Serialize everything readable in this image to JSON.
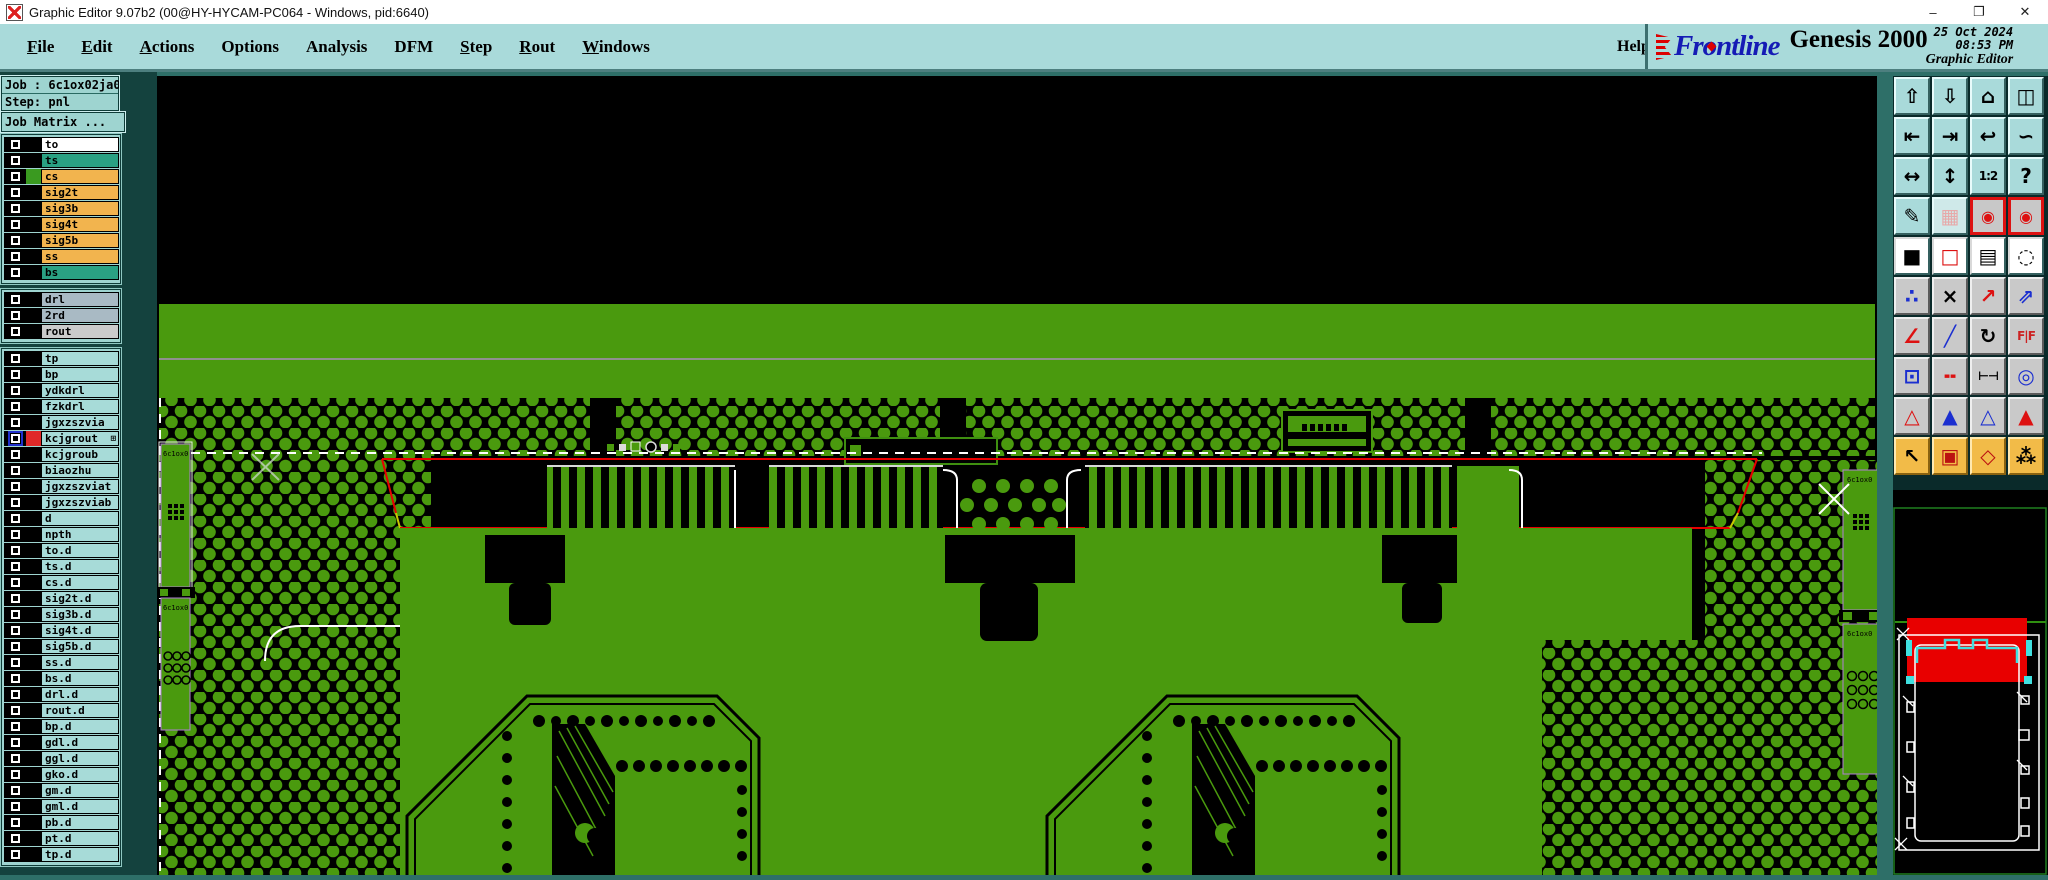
{
  "window": {
    "title": "Graphic Editor 9.07b2 (00@HY-HYCAM-PC064 - Windows, pid:6640)",
    "minimize": "–",
    "maximize": "❐",
    "close": "✕"
  },
  "menu": {
    "items": [
      {
        "label": "File",
        "underline": 0
      },
      {
        "label": "Edit",
        "underline": 0
      },
      {
        "label": "Actions",
        "underline": 0
      },
      {
        "label": "Options",
        "underline": -1
      },
      {
        "label": "Analysis",
        "underline": -1
      },
      {
        "label": "DFM",
        "underline": -1
      },
      {
        "label": "Step",
        "underline": 0
      },
      {
        "label": "Rout",
        "underline": 0
      },
      {
        "label": "Windows",
        "underline": 0
      }
    ],
    "help": "Help"
  },
  "branding": {
    "logo_pre": "Fr",
    "logo_o": "o",
    "logo_post": "ntline",
    "product": "Genesis 2000",
    "date": "25 Oct 2024",
    "time": "08:53 PM",
    "subtitle": "Graphic Editor"
  },
  "sidebar": {
    "job_line": "Job : 6c1ox02ja0",
    "step_line": "Step: pnl",
    "job_matrix": "Job Matrix ...",
    "layer_groups": [
      {
        "rows": [
          {
            "name": "to",
            "bg": "#ffffff"
          },
          {
            "name": "ts",
            "bg": "#2aa183"
          },
          {
            "name": "cs",
            "bg": "#f2b44e",
            "swatch": "#3a9a20"
          },
          {
            "name": "sig2t",
            "bg": "#f2b44e"
          },
          {
            "name": "sig3b",
            "bg": "#f2b44e"
          },
          {
            "name": "sig4t",
            "bg": "#f2b44e"
          },
          {
            "name": "sig5b",
            "bg": "#f2b44e"
          },
          {
            "name": "ss",
            "bg": "#f2b44e"
          },
          {
            "name": "bs",
            "bg": "#2aa183"
          }
        ]
      },
      {
        "rows": [
          {
            "name": "drl",
            "bg": "#a9bac4"
          },
          {
            "name": "2rd",
            "bg": "#a9bac4"
          },
          {
            "name": "rout",
            "bg": "#cbcbcb"
          }
        ]
      },
      {
        "rows": [
          {
            "name": "tp",
            "bg": "#a7dbd8"
          },
          {
            "name": "bp",
            "bg": "#a7dbd8"
          },
          {
            "name": "ydkdrl",
            "bg": "#a7dbd8"
          },
          {
            "name": "fzkdrl",
            "bg": "#a7dbd8"
          },
          {
            "name": "jgxzszvia",
            "bg": "#a7dbd8"
          },
          {
            "name": "kcjgrout",
            "bg": "#a7dbd8",
            "swatch": "#e02828",
            "selected": true,
            "suffix": "⊞"
          },
          {
            "name": "kcjgroub",
            "bg": "#a7dbd8"
          },
          {
            "name": "biaozhu",
            "bg": "#a7dbd8"
          },
          {
            "name": "jgxzszviat",
            "bg": "#a7dbd8"
          },
          {
            "name": "jgxzszviab",
            "bg": "#a7dbd8"
          },
          {
            "name": "d",
            "bg": "#a7dbd8"
          },
          {
            "name": "npth",
            "bg": "#a7dbd8"
          },
          {
            "name": "to.d",
            "bg": "#a7dbd8"
          },
          {
            "name": "ts.d",
            "bg": "#a7dbd8"
          },
          {
            "name": "cs.d",
            "bg": "#a7dbd8"
          },
          {
            "name": "sig2t.d",
            "bg": "#a7dbd8"
          },
          {
            "name": "sig3b.d",
            "bg": "#a7dbd8"
          },
          {
            "name": "sig4t.d",
            "bg": "#a7dbd8"
          },
          {
            "name": "sig5b.d",
            "bg": "#a7dbd8"
          },
          {
            "name": "ss.d",
            "bg": "#a7dbd8"
          },
          {
            "name": "bs.d",
            "bg": "#a7dbd8"
          },
          {
            "name": "drl.d",
            "bg": "#a7dbd8"
          },
          {
            "name": "rout.d",
            "bg": "#a7dbd8"
          },
          {
            "name": "bp.d",
            "bg": "#a7dbd8"
          },
          {
            "name": "gdl.d",
            "bg": "#a7dbd8"
          },
          {
            "name": "ggl.d",
            "bg": "#a7dbd8"
          },
          {
            "name": "gko.d",
            "bg": "#a7dbd8"
          },
          {
            "name": "gm.d",
            "bg": "#a7dbd8"
          },
          {
            "name": "gml.d",
            "bg": "#a7dbd8"
          },
          {
            "name": "pb.d",
            "bg": "#a7dbd8"
          },
          {
            "name": "pt.d",
            "bg": "#a7dbd8"
          },
          {
            "name": "tp.d",
            "bg": "#a7dbd8"
          }
        ]
      }
    ]
  },
  "toolbar": {
    "buttons": [
      {
        "n": "zoom-in-view-button",
        "g": "⇧",
        "s": "t"
      },
      {
        "n": "zoom-out-view-button",
        "g": "⇩",
        "s": "t"
      },
      {
        "n": "home-view-button",
        "g": "⌂",
        "s": "t"
      },
      {
        "n": "split-window-xy-button",
        "g": "◫",
        "s": "t"
      },
      {
        "n": "pan-left-button",
        "g": "⇤",
        "s": "t"
      },
      {
        "n": "pan-right-button",
        "g": "⇥",
        "s": "t"
      },
      {
        "n": "undo-view-button",
        "g": "↩",
        "s": "t"
      },
      {
        "n": "serpentine-view-button",
        "g": "∽",
        "s": "t"
      },
      {
        "n": "fit-all-button",
        "g": "↔",
        "s": "t"
      },
      {
        "n": "center-view-button",
        "g": "↕",
        "s": "t"
      },
      {
        "n": "scale-1-2-button",
        "g": "1:2",
        "s": "t",
        "sm": true
      },
      {
        "n": "context-help-button",
        "g": "?",
        "s": "t"
      },
      {
        "n": "editor-setup-button",
        "g": "✎",
        "s": "t"
      },
      {
        "n": "grid-toggle-button",
        "g": "▦",
        "s": "tl"
      },
      {
        "n": "layers-display-a-button",
        "g": "◉",
        "s": "rf"
      },
      {
        "n": "layers-display-b-button",
        "g": "◉",
        "s": "rf"
      },
      {
        "n": "capture-dark-button",
        "g": "■",
        "s": "w"
      },
      {
        "n": "capture-outline-button",
        "g": "□",
        "s": "w",
        "c": "#d11"
      },
      {
        "n": "measure-ruler-button",
        "g": "▤",
        "s": "w"
      },
      {
        "n": "pad-dashed-button",
        "g": "◌",
        "s": "w"
      },
      {
        "n": "net-connect-button",
        "g": "∴",
        "s": "gy",
        "c": "#1b2fd0"
      },
      {
        "n": "object-delete-button",
        "g": "×",
        "s": "gy"
      },
      {
        "n": "move-object-button",
        "g": "↗",
        "s": "gy",
        "c": "#d11"
      },
      {
        "n": "copy-object-button",
        "g": "⇗",
        "s": "gy",
        "c": "#1b2fd0"
      },
      {
        "n": "measure-angle-button",
        "g": "∠",
        "s": "gy",
        "c": "#d11"
      },
      {
        "n": "measure-line-button",
        "g": "╱",
        "s": "gy",
        "c": "#1b2fd0"
      },
      {
        "n": "rotate-object-button",
        "g": "↻",
        "s": "gy"
      },
      {
        "n": "mirror-object-button",
        "g": "F|F",
        "s": "gy",
        "c": "#c22",
        "sm": true
      },
      {
        "n": "resize-object-button",
        "g": "⊡",
        "s": "gy",
        "c": "#1b2fd0"
      },
      {
        "n": "break-line-button",
        "g": "╍",
        "s": "gy",
        "c": "#d11"
      },
      {
        "n": "measure-gap-button",
        "g": "⊢⊣",
        "s": "gy",
        "sm": true
      },
      {
        "n": "touchup-object-button",
        "g": "◎",
        "s": "gy",
        "c": "#1b2fd0"
      },
      {
        "n": "select-mode-a-button",
        "g": "△",
        "s": "gy",
        "c": "#d11"
      },
      {
        "n": "select-mode-b-button",
        "g": "▲",
        "s": "gy",
        "c": "#1b2fd0"
      },
      {
        "n": "select-mode-c-button",
        "g": "△",
        "s": "gy",
        "c": "#1b2fd0"
      },
      {
        "n": "select-mode-d-button",
        "g": "▲",
        "s": "gy",
        "c": "#d11"
      },
      {
        "n": "pointer-select-button",
        "g": "↖",
        "s": "o"
      },
      {
        "n": "frame-select-button",
        "g": "▣",
        "s": "o",
        "c": "#b11"
      },
      {
        "n": "polygon-select-button",
        "g": "◇",
        "s": "o",
        "c": "#b11"
      },
      {
        "n": "net-select-button",
        "g": "⁂",
        "s": "o"
      }
    ]
  },
  "colors": {
    "pcb_green": "#4a9a0e",
    "ui_teal": "#a9dada",
    "panel_teal": "#9ed4d0",
    "highlight_red": "#e80000",
    "overview_cyan": "#40e0e0",
    "layer_orange": "#f2b44e",
    "layer_teal": "#2aa183"
  }
}
